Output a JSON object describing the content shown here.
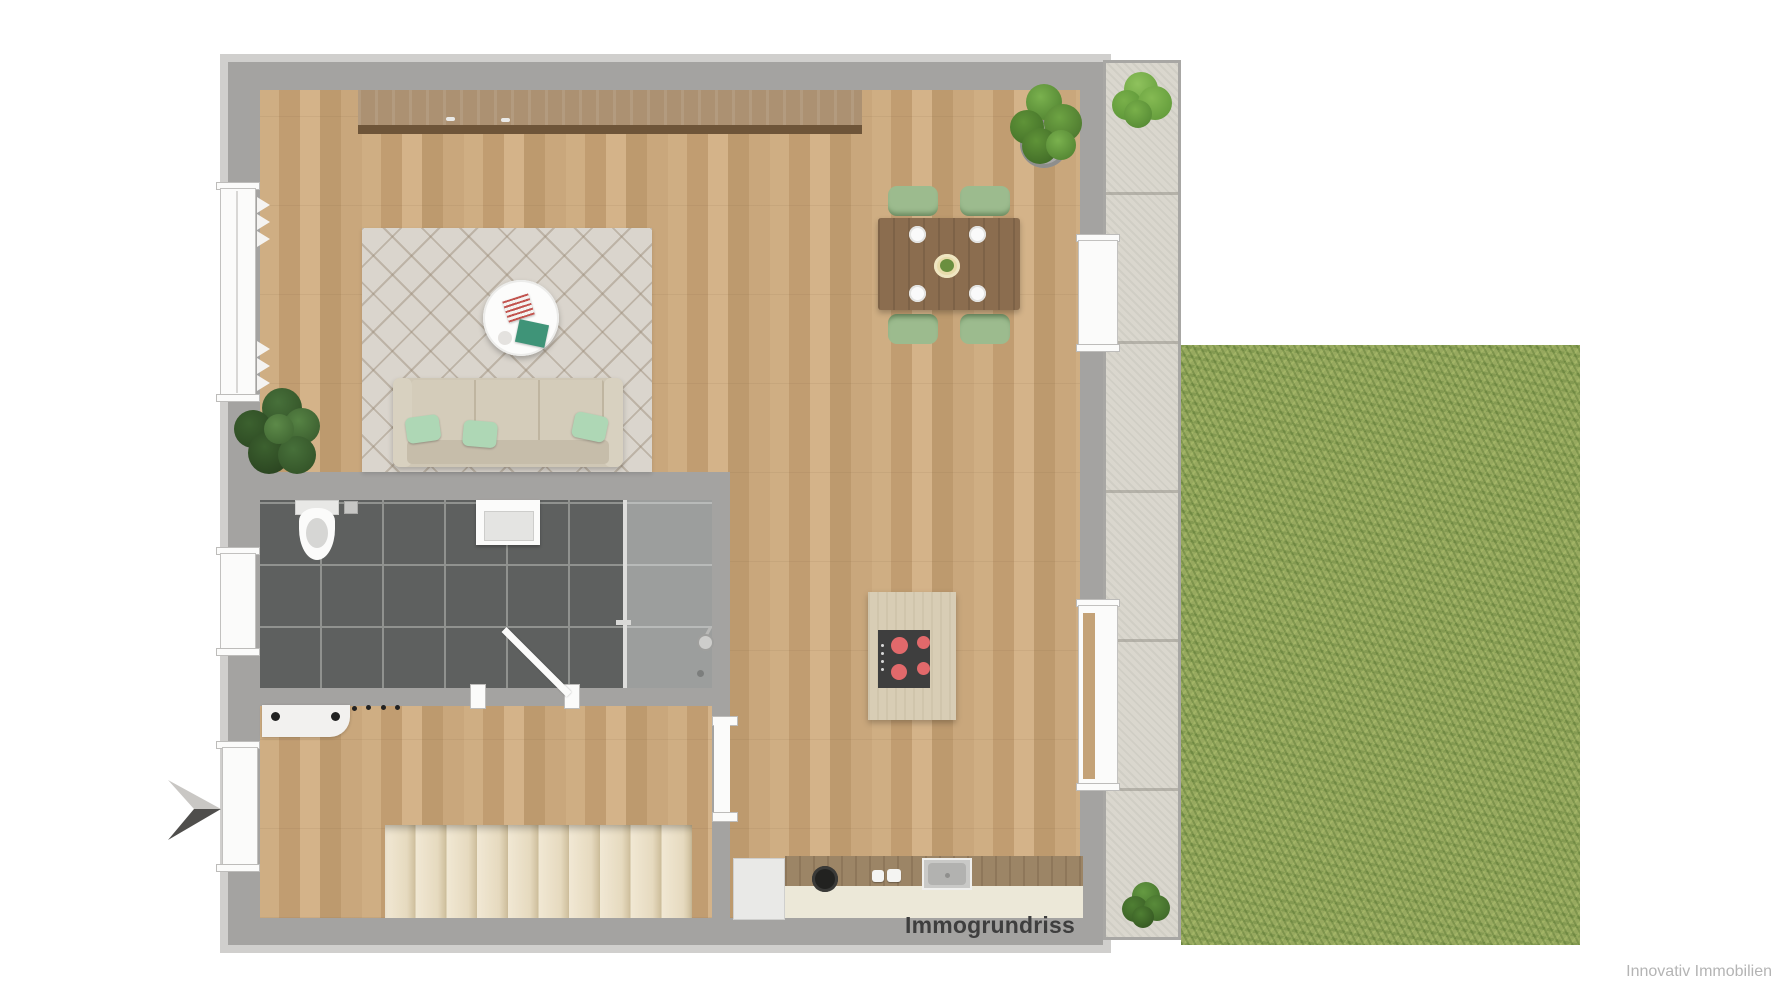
{
  "watermark": {
    "label": "Immogrundriss"
  },
  "credit": {
    "label": "Innovativ Immobilien"
  },
  "plan": {
    "type": "floor-plan-top-view",
    "rooms": [
      "open-living-dining-kitchen",
      "bathroom-with-shower",
      "hallway-with-stairs"
    ],
    "outdoor": [
      "paved-terrace-path",
      "garden-lawn"
    ],
    "furniture": [
      "sideboard",
      "area-rug",
      "round-coffee-table",
      "three-seat-sofa",
      "potted-plants",
      "dining-table-with-4-chairs",
      "kitchen-island-with-cooktop",
      "kitchen-counter-with-sink",
      "staircase",
      "coat-rack",
      "toilet",
      "washbasin",
      "shower"
    ]
  },
  "colors": {
    "wall": "#a4a3a1",
    "wood_floor": "#c8a67b",
    "bathroom_tile": "#5e605f",
    "shower_tile": "#9c9e9d",
    "rug": "#dad5cd",
    "sofa": "#cfc7b5",
    "pillow": "#aed7b5",
    "dining_table": "#8b6d4f",
    "chair": "#9cbb8e",
    "stairs": "#e9dec6",
    "kitchen_island": "#d8cdb5",
    "cooktop": "#3e3e3e",
    "burner": "#e2696b",
    "counter": "#ece8d8",
    "counter_wood": "#9c8566",
    "terrace": "#dad7ce",
    "grass": "#97a95f",
    "arrow_light": "#c9c7c4",
    "arrow_dark": "#4f4e4c",
    "watermark_text": "#3e3e3e",
    "credit_text": "#b4b4b4"
  }
}
